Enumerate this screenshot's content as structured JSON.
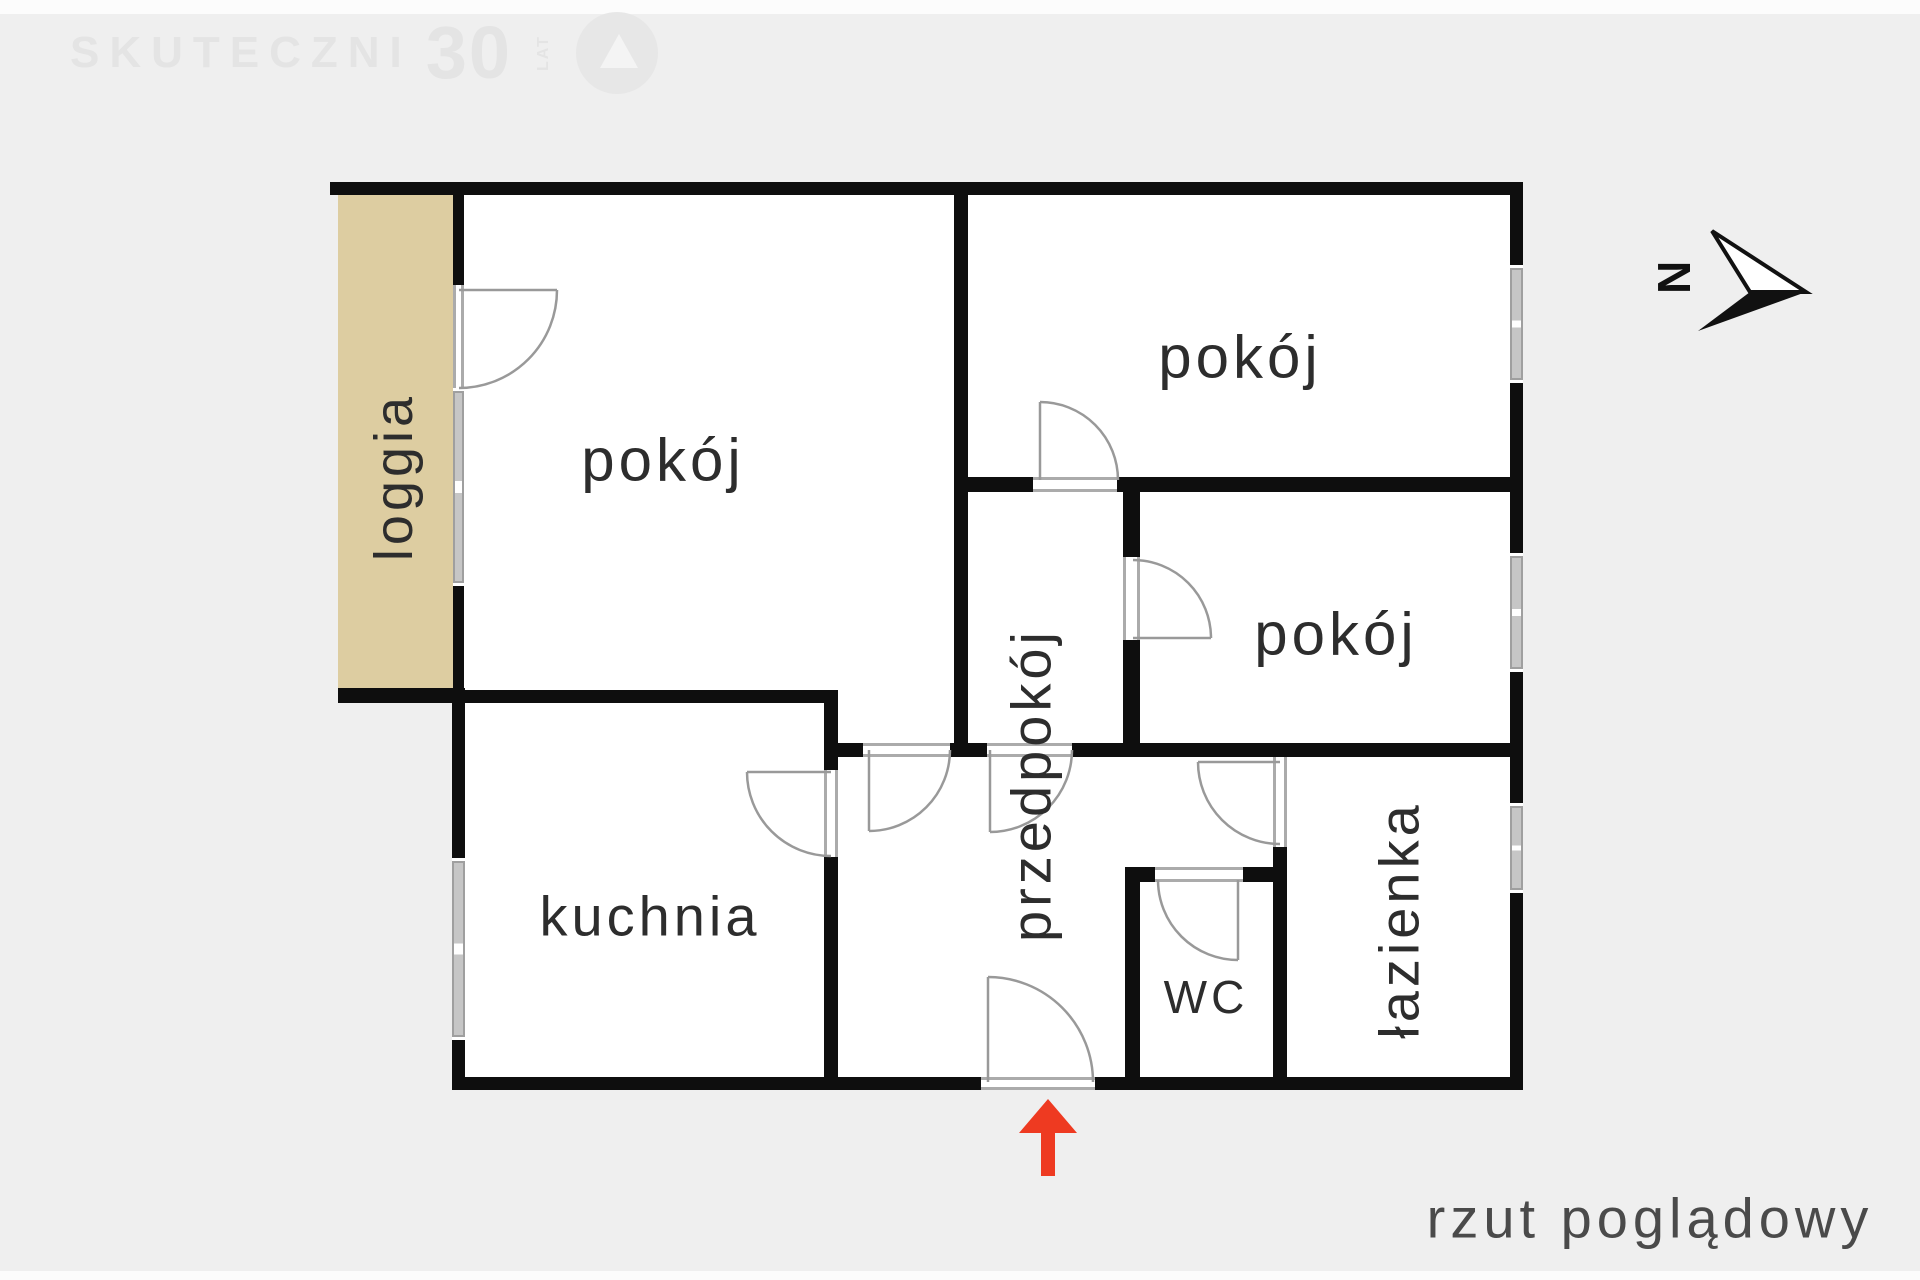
{
  "plan": {
    "caption": "rzut poglądowy",
    "rooms": [
      {
        "id": "pokoj-big",
        "label": "pokój"
      },
      {
        "id": "pokoj-top",
        "label": "pokój"
      },
      {
        "id": "pokoj-mid",
        "label": "pokój"
      },
      {
        "id": "kuchnia",
        "label": "kuchnia"
      },
      {
        "id": "wc",
        "label": "WC"
      },
      {
        "id": "loggia",
        "label": "loggia"
      },
      {
        "id": "przedpokoj",
        "label": "przedpokój"
      },
      {
        "id": "lazienka",
        "label": "łazienka"
      }
    ],
    "compass": {
      "label": "N"
    },
    "entrance_marker": "red-arrow"
  },
  "watermark": {
    "name": "SKUTECZNI",
    "number": "30",
    "unit": "LAT"
  },
  "colors": {
    "background": "#efefef",
    "wall": "#0e0e0e",
    "loggia_fill": "#ddcda1",
    "window_gray": "#c6c6c6",
    "door_line": "#999999",
    "entrance_arrow": "#ee3a21",
    "label_text": "#2d2d2d"
  }
}
